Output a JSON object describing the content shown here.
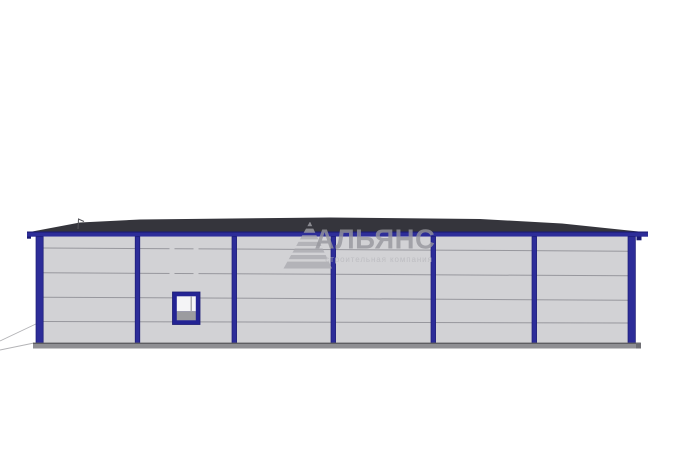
{
  "watermark": {
    "brand": "АЛЬЯНС",
    "tagline": "строительная компания",
    "logo": "striped-pyramid-icon"
  },
  "colors": {
    "background": "#ffffff",
    "roof": "#35353c",
    "frame_blue": "#2d2d99",
    "frame_blue_dark": "#1b1b74",
    "wall": "#d2d2d5",
    "seam": "#97979d",
    "base": "#8f8f93",
    "base_edge": "#5e5e62",
    "base_cap": "#6e6e73",
    "ground_line": "#b3b3b6",
    "antenna": "#55555a",
    "window_frame": "#232394",
    "window_glass": "#f4f4f6",
    "window_lower": "#9b9b9f",
    "window_mullion": "#aaaaaf",
    "watermark_logo": "rgba(168,168,173,0.75)",
    "watermark_text": "rgba(150,150,156,0.8)",
    "watermark_tagline": "rgba(187,187,192,0.9)"
  },
  "building": {
    "bays": 6,
    "columns_x": [
      36,
      137,
      234,
      333,
      433,
      534,
      628
    ],
    "panel_seams_y": [
      248,
      273,
      298,
      322
    ],
    "window": {
      "x": 173,
      "y": 292,
      "width": 27,
      "height": 32
    }
  }
}
